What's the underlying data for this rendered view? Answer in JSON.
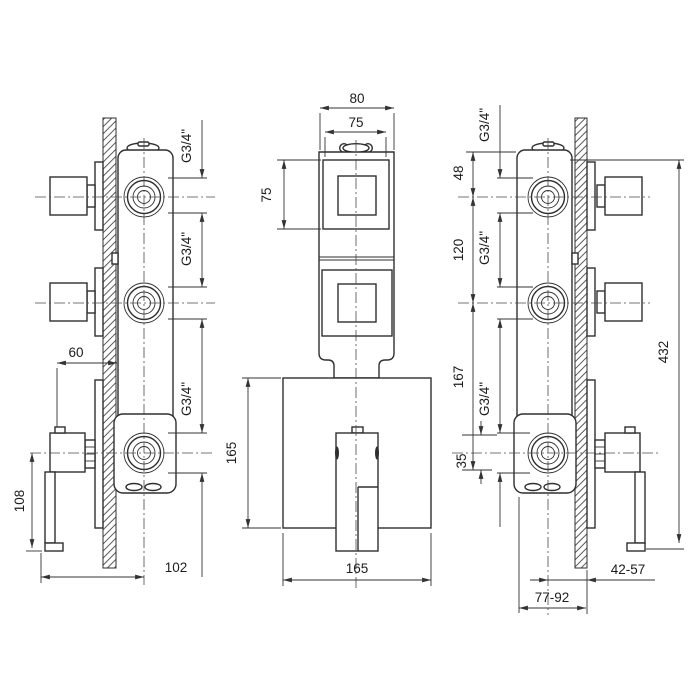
{
  "dims": {
    "left": {
      "thread_top": "G3/4\"",
      "thread_mid": "G3/4\"",
      "thread_bottom": "G3/4\"",
      "handle_offset": "60",
      "lever_length": "108",
      "depth": "102"
    },
    "front": {
      "body_width": "80",
      "knob_width": "75",
      "knob_height": "75",
      "plate_height": "165",
      "plate_width": "165"
    },
    "right": {
      "thread_top": "G3/4\"",
      "thread_mid": "G3/4\"",
      "thread_bottom": "G3/4\"",
      "top_offset": "48",
      "port_spacing": "120",
      "lower_spacing": "167",
      "port_height": "35",
      "total_height": "432",
      "wall_depth_range": "42-57",
      "install_depth_range": "77-92"
    }
  }
}
